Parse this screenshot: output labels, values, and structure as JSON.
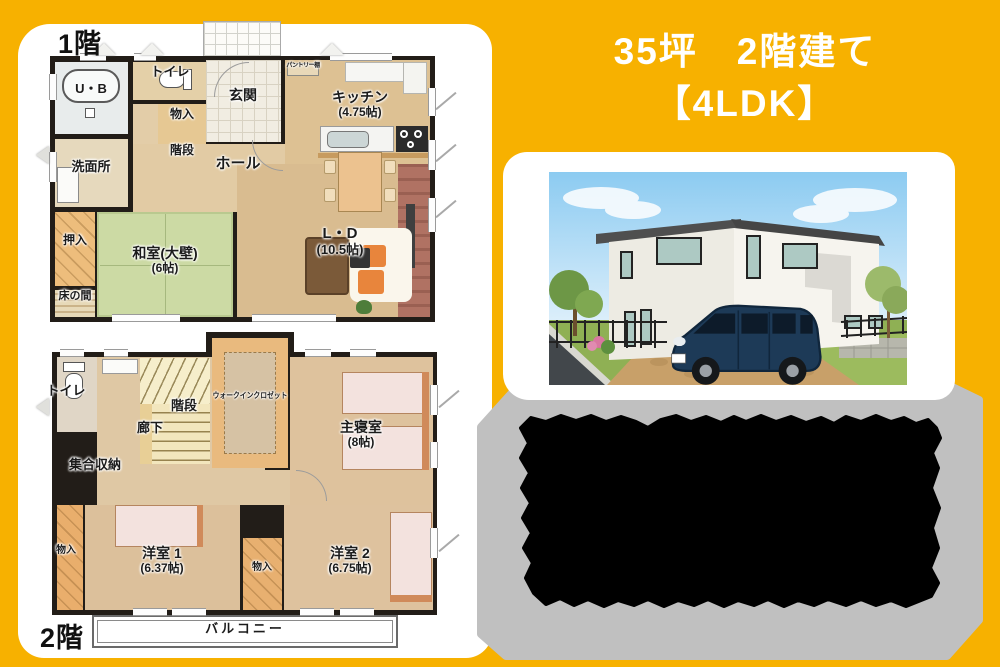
{
  "title": {
    "line1": "35坪　2階建て",
    "line2": "【4LDK】"
  },
  "floor1": {
    "label": "1階",
    "rooms": {
      "ub": "U・B",
      "toilet": "トイレ",
      "storage": "物入",
      "entrance": "玄関",
      "stairs": "階段",
      "washroom": "洗面所",
      "hall": "ホール",
      "kitchen": "キッチン",
      "kitchen_size": "(4.75帖)",
      "pantry": "パントリー棚",
      "oshiire": "押入",
      "washitsu": "和室(大壁)",
      "washitsu_size": "(6帖)",
      "tokonoma": "床の間",
      "ld": "L・D",
      "ld_size": "(10.5帖)"
    }
  },
  "floor2": {
    "label": "2階",
    "rooms": {
      "toilet": "トイレ",
      "stairs": "階段",
      "hallway": "廊下",
      "wic": "ウォークインクロゼット",
      "master": "主寝室",
      "master_size": "(8帖)",
      "storage": "集合収納",
      "closet_left": "物入",
      "bedroom1": "洋室 1",
      "bedroom1_size": "(6.37帖)",
      "closet_mid": "物入",
      "bedroom2": "洋室 2",
      "bedroom2_size": "(6.75帖)",
      "balcony": "バルコニー"
    }
  },
  "colors": {
    "background": "#F7B100",
    "panel": "#FFFFFF",
    "info_panel": "#C0C0C0",
    "redaction": "#000000",
    "wall": "#221D18",
    "tatami": "#CCDAA4",
    "wood": "#DDC193",
    "title_text": "#FFFFFF"
  }
}
